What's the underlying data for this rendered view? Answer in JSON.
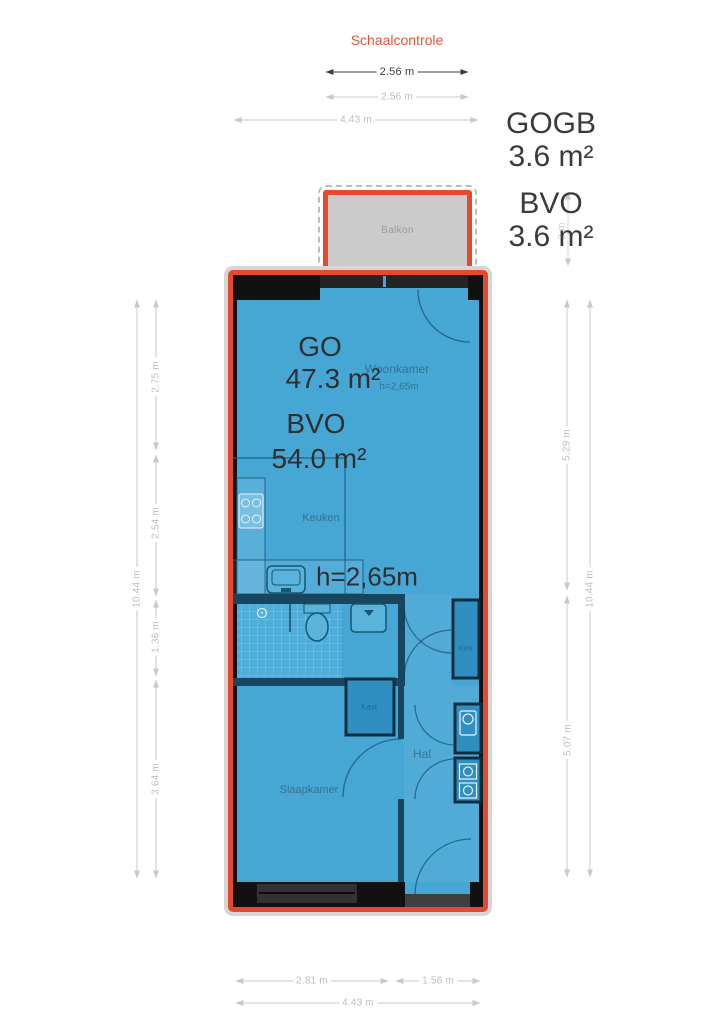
{
  "scale_check": {
    "title": "Schaalcontrole",
    "dim1": "2.56 m",
    "dim2": "2.56 m",
    "dim3": "4.43 m"
  },
  "balcony": {
    "label": "Balkon",
    "gogb_label": "GOGB",
    "gogb_value": "3.6 m²",
    "bvo_label": "BVO",
    "bvo_value": "3.6 m²",
    "depth_dim": "2 m"
  },
  "plan": {
    "go_label": "GO",
    "go_value": "47.3 m²",
    "bvo_label": "BVO",
    "bvo_value": "54.0 m²",
    "ceiling_height": "h=2,65m",
    "rooms": {
      "woonkamer": "Woonkamer",
      "woonkamer_height": "h=2,65m",
      "keuken": "Keuken",
      "slaapkamer": "Slaapkamer",
      "hal": "Hal",
      "kast_middle": "Kast",
      "kast_right": "Kast"
    }
  },
  "dimensions": {
    "left_inner": [
      "2.75 m",
      "2.54 m",
      "1.36 m",
      "3.64 m"
    ],
    "left_outer": "10.44 m",
    "right_inner": [
      "5.29 m",
      "5.07 m"
    ],
    "right_outer": "10.44 m",
    "bottom_inner": [
      "2.81 m",
      "1.56 m"
    ],
    "bottom_outer": "4.43 m"
  },
  "colors": {
    "accent_red": "#e64a2e",
    "plan_blue": "#46a7d5",
    "wall_black": "#111111",
    "balcony_gray": "#cbcbcb",
    "dim_gray": "#c9c9c9"
  }
}
